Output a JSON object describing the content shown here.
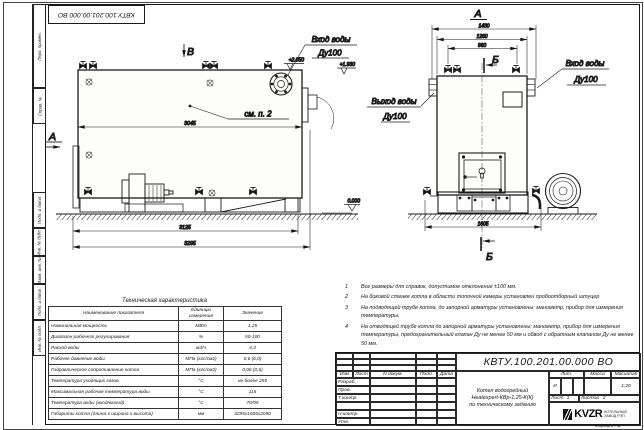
{
  "colors": {
    "ink": "#1b1b1b",
    "paper": "#ffffff",
    "body_fill": "#fdfdfb"
  },
  "frame": {
    "top_stamp": "КВТУ.100.201.00.000 ВО",
    "left_labels": [
      "Перв. примен.",
      "Справ. №",
      "Подп. и дата",
      "Инв. № дубл.",
      "Взам. инв. №",
      "Подп. и дата",
      "Инв. № подл."
    ],
    "format_label": "Формат А3"
  },
  "drawing": {
    "side": {
      "label_v": "В",
      "label_a": "А",
      "callout": "см. п. 2",
      "dim_width": "3045",
      "dim_base": "3125",
      "dim_total": "3295",
      "elev_top": "+2.050",
      "elev_inlet": "+1.930",
      "elev_zero": "0.000",
      "inlet_line1": "Вход воды",
      "inlet_line2": "Ду100"
    },
    "front": {
      "label": "А",
      "section": "Б",
      "dim_1430": "1430",
      "dim_1260": "1260",
      "dim_960": "960",
      "dim_1605": "1605",
      "outlet_line1": "Выход воды",
      "outlet_line2": "Ду100",
      "inlet_line1": "Вход воды",
      "inlet_line2": "Ду100"
    }
  },
  "tech_table": {
    "title": "Техническая характеристика",
    "headers": [
      "Наименование показателя",
      "Единицы измерения",
      "Значение"
    ],
    "rows": [
      [
        "Номинальная мощность",
        "МВт",
        "1,25"
      ],
      [
        "Диапазон рабочего регулирования",
        "%",
        "50-100"
      ],
      [
        "Расход воды",
        "м3/ч",
        "4,3"
      ],
      [
        "Рабочее давление воды",
        "МПа (кгс/см2)",
        "0,6 (6,0)"
      ],
      [
        "Гидравлическое сопротивление котла",
        "МПа (кгс/см2)",
        "0,06 (0,6)"
      ],
      [
        "Температура уходящих газов",
        "°С",
        "не более 250"
      ],
      [
        "Максимальная рабочая температура воды",
        "°С",
        "115"
      ],
      [
        "Температура воды (вход/выход)",
        "°С",
        "70/95"
      ],
      [
        "Габариты котла (длина х ширина х высота)",
        "мм",
        "3295х1605х2050"
      ]
    ]
  },
  "notes": [
    {
      "num": "1",
      "text": "Все размеры для справок, допустимое отклонение ±100 мм."
    },
    {
      "num": "2",
      "text": "На боковой стенке котла в области топочной камеры установлен пробоотборный штуцер"
    },
    {
      "num": "3",
      "text": "На подводящей трубе котла, до запорной арматуры установлены: манометр, прибор для измерения температуры."
    },
    {
      "num": "4",
      "text": "На отводящей трубе котла до запорной арматуры установлены: манометр, прибор для измерения температуры, предохранительный клапан Ду не менее 50 мм и обвод с обратным клапаном Ду не менее 50 мм."
    }
  ],
  "title_block": {
    "doc_number": "КВТУ.100.201.00.000  ВО",
    "header_cells": [
      "Изм",
      "Лист",
      "N докум.",
      "Подп.",
      "Дата"
    ],
    "role_rows": [
      "Разраб.",
      "Пров.",
      "Т.контр.",
      "",
      "Н.контр.",
      "Утв."
    ],
    "description_line1": "Котел водогрейный",
    "description_line2": "Heatexpert-КВр-1,25-К(К)",
    "description_line3": "по техническому заданию",
    "lit_header": "Лит.",
    "mass_header": "Масса",
    "scale_header": "Масштаб",
    "lit_value": "И",
    "scale_value": "1:20",
    "sheet_label": "Лист",
    "sheet_value": "1",
    "sheets_label": "Листов",
    "sheets_value": "2",
    "logo_text": "KVZR",
    "logo_sub1": "КОТЕЛЬНЫЙ",
    "logo_sub2": "ЗАВОД РЭП"
  }
}
